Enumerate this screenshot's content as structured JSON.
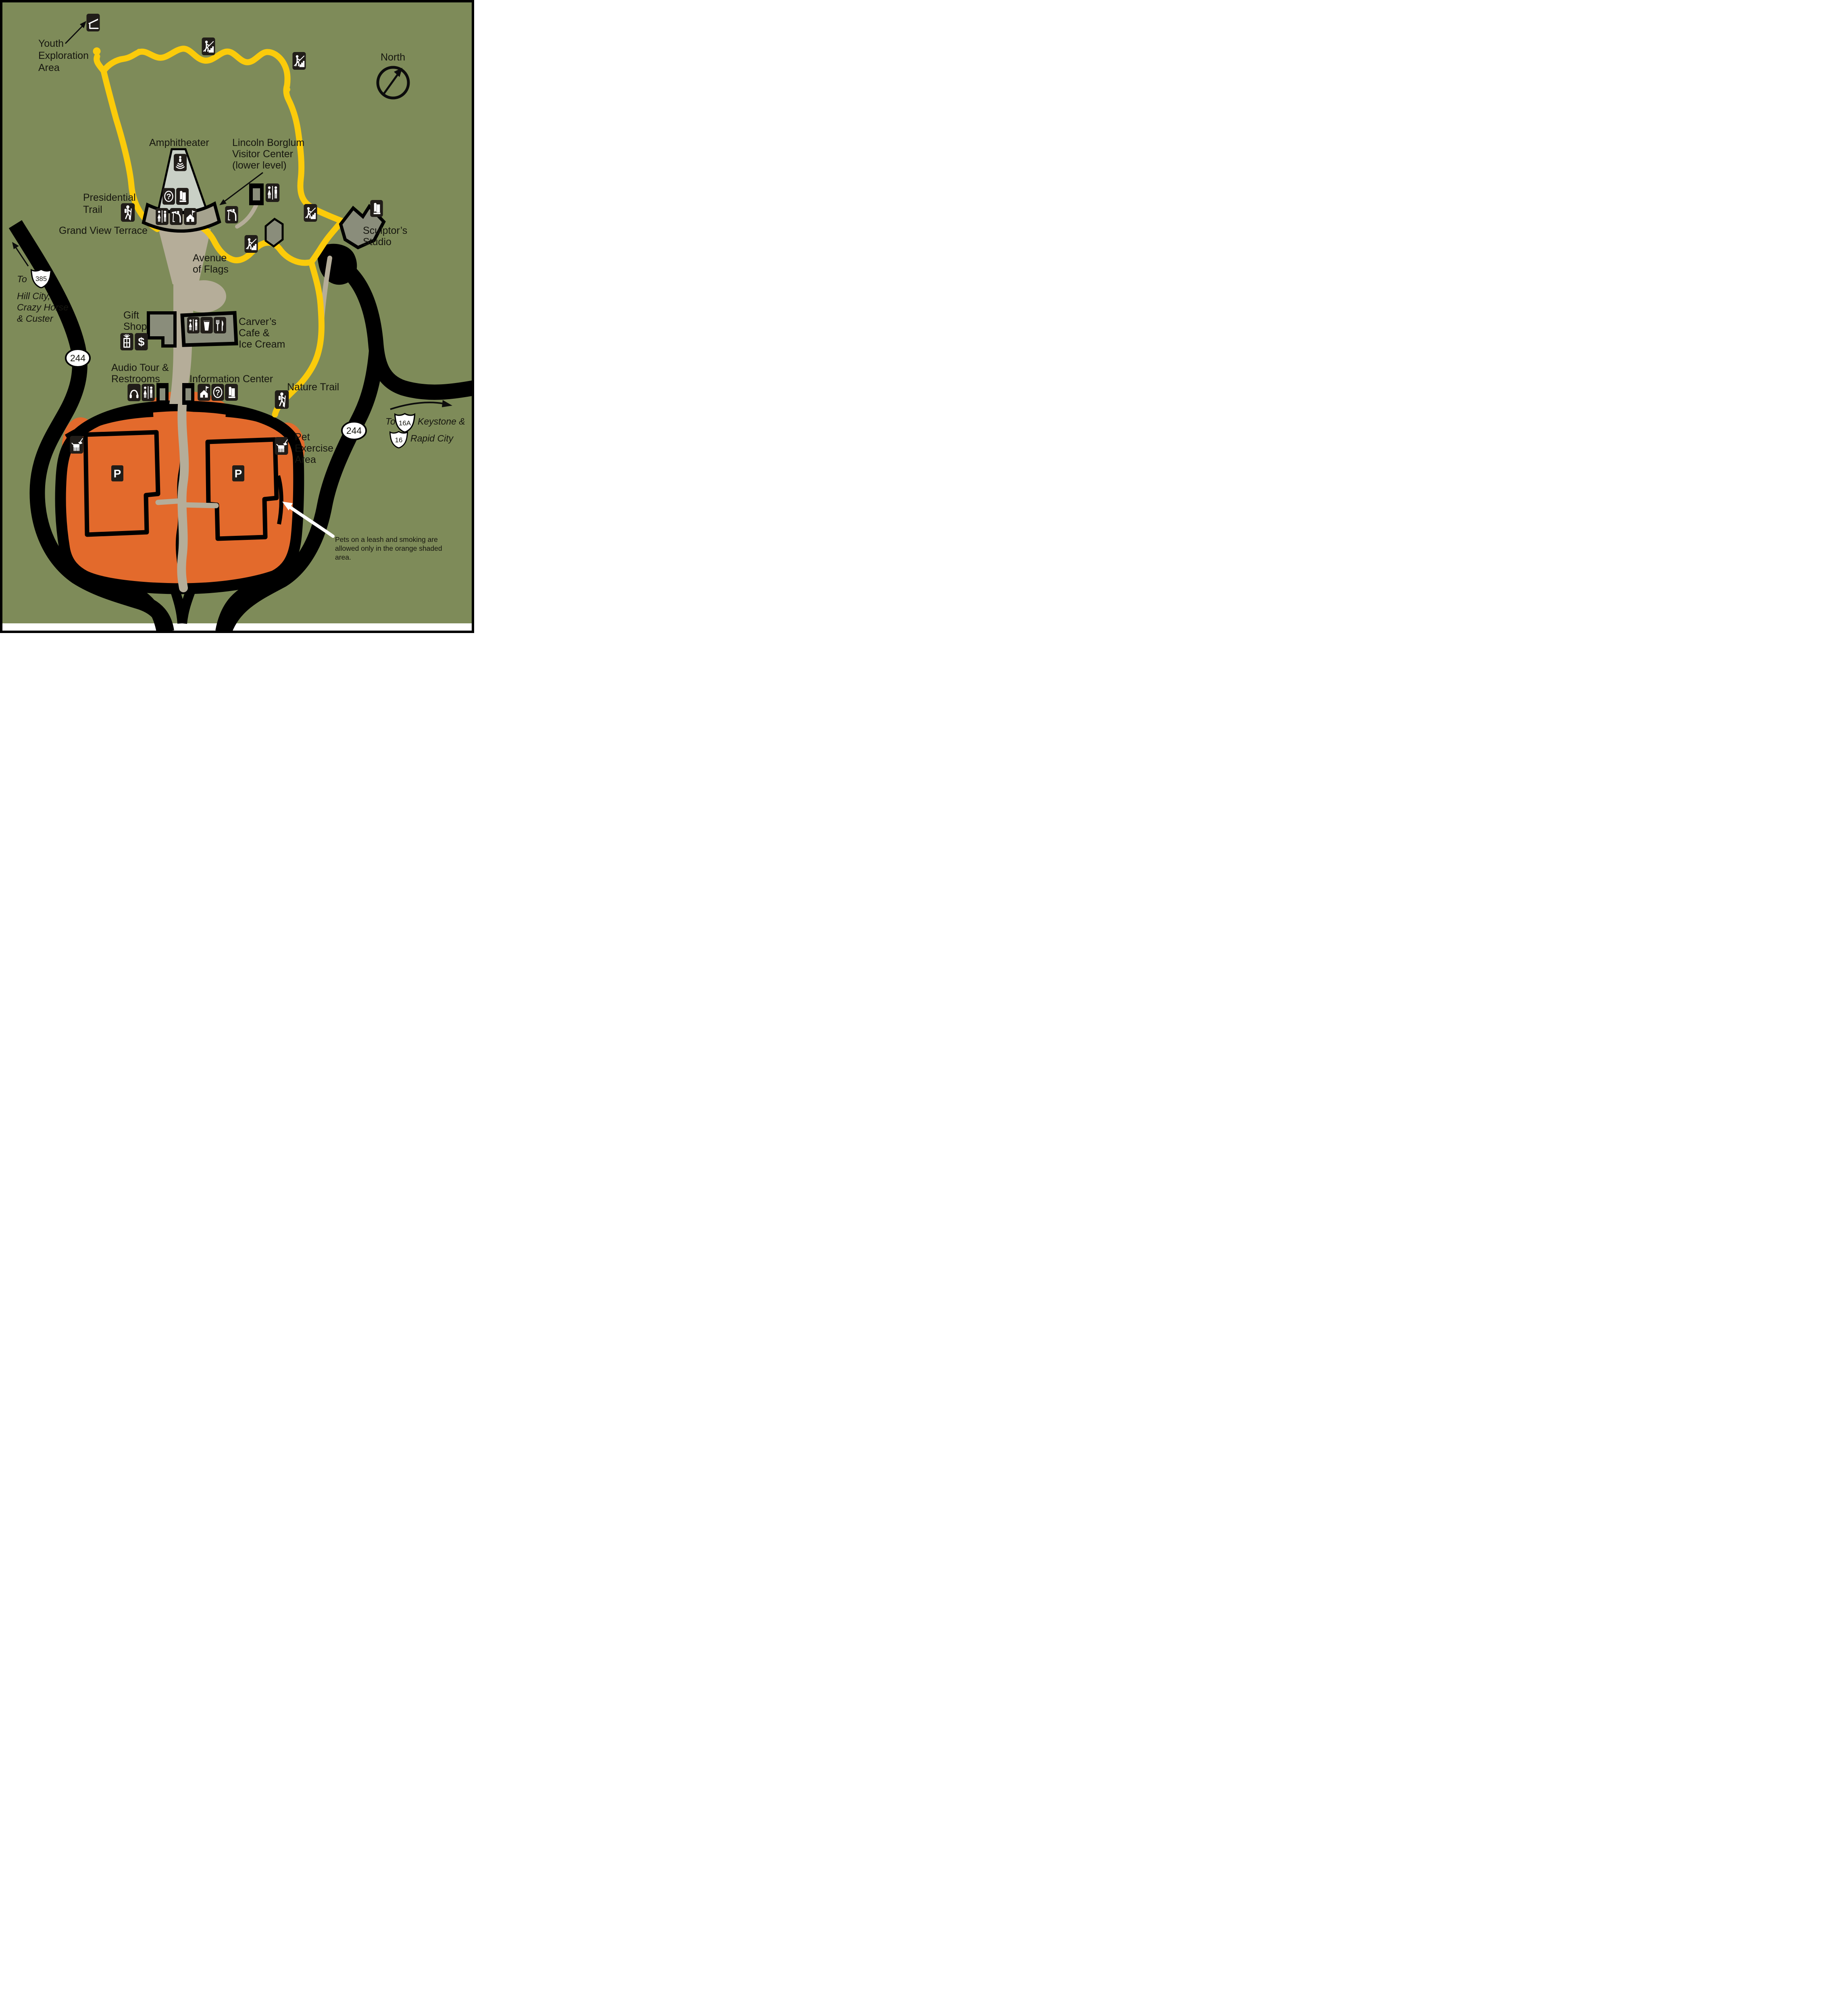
{
  "labels": {
    "youth_line1": "Youth",
    "youth_line2": "Exploration",
    "youth_line3": "Area",
    "north": "North",
    "amphitheater": "Amphitheater",
    "lincoln_line1": "Lincoln Borglum",
    "lincoln_line2": "Visitor Center",
    "lincoln_line3": "(lower level)",
    "presidential_line1": "Presidential",
    "presidential_line2": "Trail",
    "grand_view_terrace": "Grand View Terrace",
    "avenue_line1": "Avenue",
    "avenue_line2": "of Flags",
    "sculptors_line1": "Sculptor’s",
    "sculptors_line2": "Studio",
    "to_385_prefix": "To",
    "hill_city": "Hill City,",
    "crazy_horse": "Crazy Horse",
    "custer": "& Custer",
    "gift_line1": "Gift",
    "gift_line2": "Shop",
    "carvers_line1": "Carver’s",
    "carvers_line2": "Cafe &",
    "carvers_line3": "Ice Cream",
    "audio_line1": "Audio Tour &",
    "audio_line2": "Restrooms",
    "information_center": "Information Center",
    "nature_trail": "Nature Trail",
    "to_16_prefix": "To",
    "keystone": "Keystone &",
    "rapid_city": "Rapid City",
    "pet_line1": "Pet",
    "pet_line2": "Exercise",
    "pet_line3": "Area",
    "note_line1": "Pets on a leash and smoking are",
    "note_line2": "allowed only in the orange shaded",
    "note_line3": "area."
  },
  "route_shields": {
    "sd_244": "244",
    "us_385": "385",
    "us_16a": "16A",
    "us_16": "16"
  },
  "glyphs": {
    "parking": "P",
    "question": "?",
    "dollar": "$"
  },
  "colors": {
    "bg-green": "#7e8b59",
    "trail-yellow": "#fbcb0a",
    "pet-orange": "#e36a2c",
    "walkway-tan": "#b5ad99",
    "building-gray": "#8a8d7b",
    "amph-sage": "#c9d0c6",
    "road-black": "#000000",
    "shield-white": "#ffffff"
  },
  "icons": [
    "shelter-icon",
    "stairs-icon",
    "hiker-icon",
    "restrooms-icon",
    "viewpoint-icon",
    "historic-building-flag-icon",
    "question-icon",
    "brochure-icon",
    "gift-icon",
    "dollar-icon",
    "drink-cup-icon",
    "fork-knife-icon",
    "headphones-icon",
    "dog-on-leash-icon",
    "parking-icon",
    "amphitheater-speaker-icon",
    "north-compass-icon"
  ]
}
